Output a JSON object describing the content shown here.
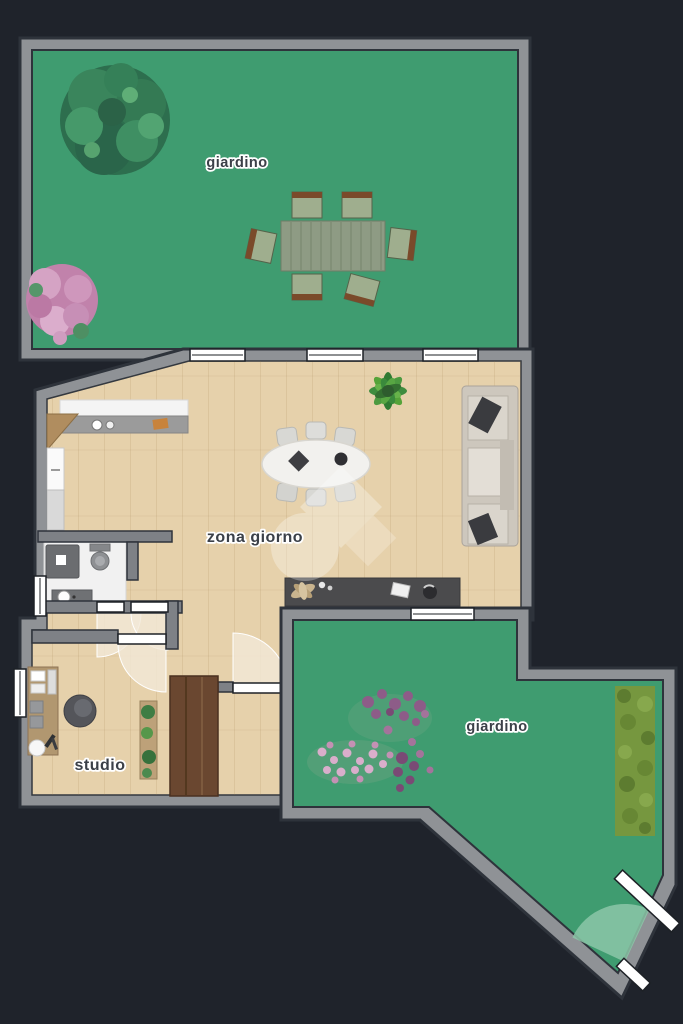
{
  "floorplan": {
    "title": "apartment floor plan with gardens",
    "labels": {
      "garden_top": "giardino",
      "living_area": "zona giorno",
      "studio": "studio",
      "garden_bottom": "giardino"
    },
    "rooms": [
      {
        "name": "giardino",
        "type": "garden",
        "position": "top",
        "features": [
          "tree",
          "flower-bush",
          "outdoor-dining-table",
          "six-chairs",
          "three-windows"
        ]
      },
      {
        "name": "zona giorno",
        "type": "living-area",
        "position": "center",
        "features": [
          "kitchen-counter",
          "sink",
          "fridge",
          "oval-dining-table",
          "six-chairs",
          "sofa-shelf-unit",
          "houseplant",
          "dark-sideboard",
          "watermark"
        ]
      },
      {
        "name": "bagno",
        "type": "bathroom",
        "position": "mid-left",
        "features": [
          "shower",
          "toilet",
          "washbasin"
        ]
      },
      {
        "name": "studio",
        "type": "office",
        "position": "bottom-left",
        "features": [
          "desk",
          "office-chair",
          "plant-shelf",
          "window"
        ]
      },
      {
        "name": "giardino",
        "type": "garden",
        "position": "bottom-right",
        "features": [
          "lavender-beds",
          "hedge",
          "gate-with-swing"
        ]
      }
    ],
    "colors": {
      "background": "#1f232b",
      "wall": "#8f9296",
      "wall_outline": "#2e333b",
      "garden": "#3f9c70",
      "wood_floor": "#e6d1ab",
      "bathroom_floor": "#f1f1f1",
      "hedge": "#76973f",
      "wardrobe": "#6a4730",
      "sideboard": "#4b4b4d",
      "label_text": "#3b4048",
      "label_halo": "#ffffff"
    }
  }
}
